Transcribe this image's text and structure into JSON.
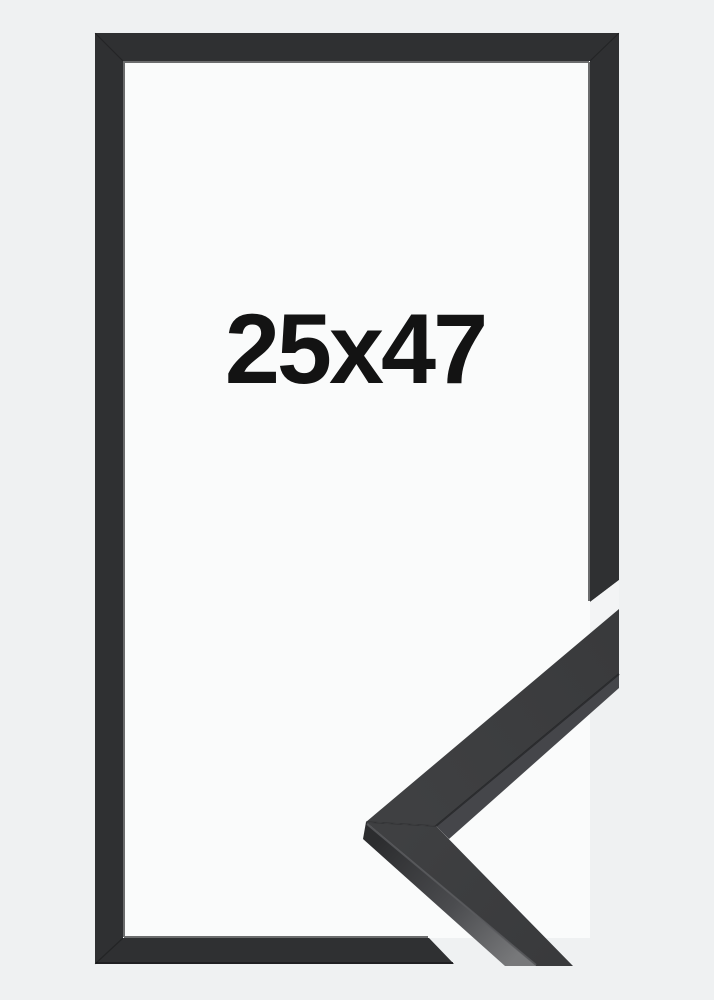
{
  "product": {
    "size_label": "25x47"
  },
  "colors": {
    "background": "#eff1f2",
    "frame_opening_white": "#fafbfb",
    "frame_moulding": "#2f3032",
    "frame_inner_edge_dark": "#1e1f21",
    "frame_outer_edge_dark": "#1b1c1e",
    "cut_gap": "#f3f4f5",
    "sample_face": "#393a3c",
    "sample_face_light": "#3f4042",
    "sample_side_dark": "#2c2d2f",
    "sample_side_mid": "#4b4c4f",
    "sample_side_light": "#77787a",
    "sample_stripe": "#45464a",
    "crease_dark": "#232426",
    "crease_light": "#5a5b5e",
    "label_text": "#131313"
  }
}
